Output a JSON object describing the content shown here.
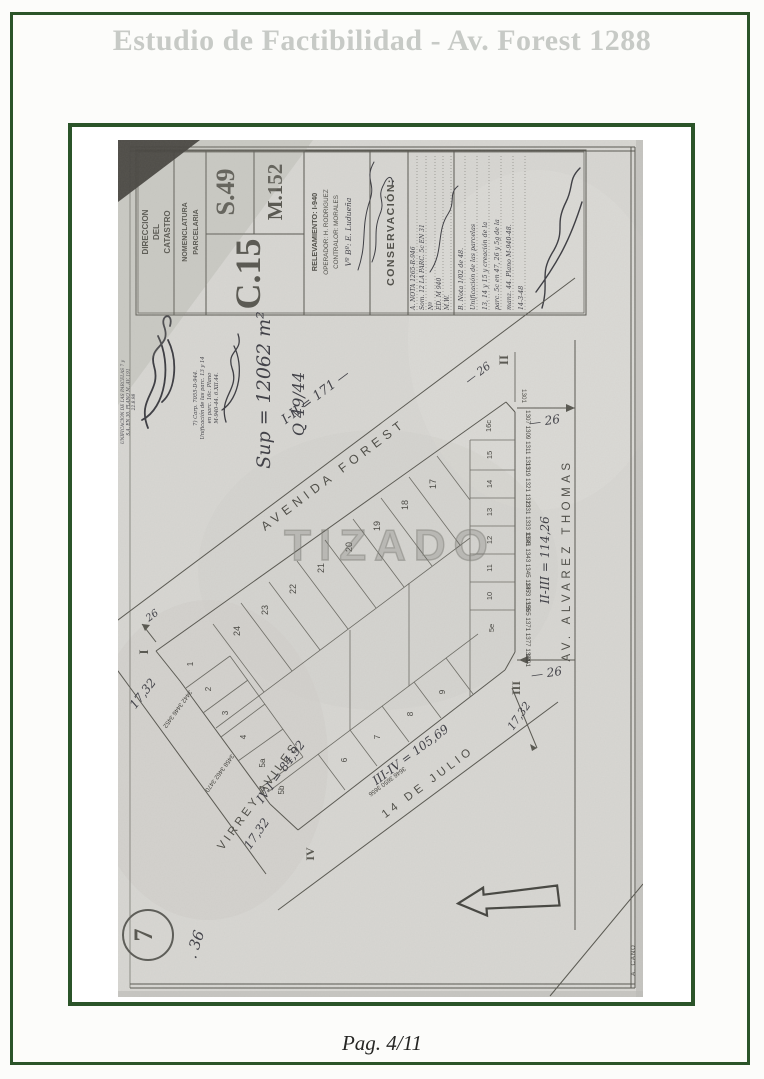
{
  "page": {
    "title": "Estudio de Factibilidad - Av. Forest 1288",
    "footer": "Pag. 4/11",
    "accent_green": "#2b5429",
    "title_gray": "#c7cac6"
  },
  "titleblock": {
    "direccion_lines": [
      "DIRECCION",
      "DEL",
      "CATASTRO"
    ],
    "nomenclatura_lines": [
      "NOMENCLATURA",
      "PARCELARIA"
    ],
    "seccion": "S.49",
    "manzana": "M.152",
    "circunscripcion": "C.15",
    "relevamiento": "RELEVAMIENTO: I-940",
    "operador": "OPERADOR: H. RODRIGUEZ",
    "contralor": "CONTRALOR: MORALES",
    "vobo": "Vº Bº: E. Ludueña",
    "conservacion": "CONSERVACIÓN:",
    "entry_a": [
      "A. NOTA 1265-R-946",
      "Som. 12 LA PARC. 5c EN 31",
      "Nº",
      "ED. M 940",
      "M.W."
    ],
    "entry_b": [
      "B. Nota 1/02 de 48.",
      "Unificación de las parcelas",
      "13, 14 y 15 y creación de la",
      "parc. 5c en 47, 26 y 5g de la",
      "manz. 44. Plano M-940-48.",
      "14-3-48"
    ]
  },
  "annotations": {
    "margin_lines": [
      "UNIFICACION DE LAS PARCELAS 7 y",
      "S.A. EN 30. PLANO M. AV. 191",
      "22.8.98"
    ],
    "note7_lines": [
      "7) Carp. 7055-D-944.",
      "Unificación de las parc. 13 y 14",
      "en parc. 16c. Plano",
      "M-940-44.  6.XII.44."
    ],
    "superficie": "Sup = 12062 m²",
    "expediente": "Q 49/44"
  },
  "streets": {
    "forest": {
      "name": "AVENIDA FOREST",
      "measure": "I-II = 171 —"
    },
    "alvarez": {
      "name": "AV. ALVAREZ THOMAS",
      "measure": "II-III = 114,26"
    },
    "julio": {
      "name": "14 DE JULIO",
      "measure": "III-IV = 105,69"
    },
    "aviles": {
      "name": "VIRREY AVILES",
      "measure": "IV-I = 84,92"
    }
  },
  "corners": {
    "i": "I",
    "ii": "II",
    "iii": "III",
    "iv": "IV"
  },
  "measures": {
    "ochava_i": "17,32",
    "ochava_iii": "17,32",
    "ochava_iv": "17,32",
    "width_i": "26",
    "width_forest": "— 26",
    "width_top": "— 26",
    "width_iii": "— 26",
    "corner_house": "1301"
  },
  "parcels": {
    "fan": [
      "17",
      "18",
      "19",
      "20",
      "21",
      "22",
      "23",
      "24"
    ],
    "right": [
      "16c",
      "15",
      "14",
      "13",
      "12",
      "11",
      "10",
      "5e"
    ],
    "left": [
      "1",
      "2",
      "3",
      "4",
      "5a",
      "5b"
    ],
    "bottom": [
      "9",
      "8",
      "7",
      "6"
    ]
  },
  "houses": {
    "alvarez": [
      "1307 1309 1311 1313",
      "1319 1321 1323",
      "1331 1333 1335",
      "1341 1343 1345 1347",
      "1353 1355",
      "1365 1371 1377 1381",
      "1391"
    ],
    "aviles": [
      "3442 3446 3452",
      "3458 3462 3470"
    ],
    "julio": [
      "3646 3650 3656"
    ]
  },
  "misc": {
    "watermark": "TIZADO",
    "stamp": "7",
    "note36": ". 36",
    "author": "A. CANO"
  }
}
